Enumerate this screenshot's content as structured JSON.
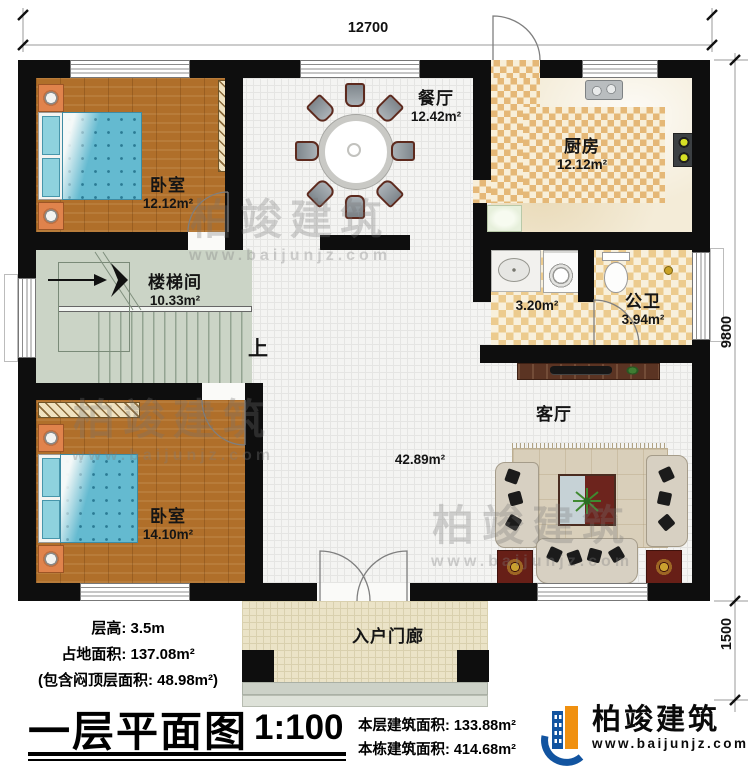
{
  "plan": {
    "dim_top": "12700",
    "dim_right": "9800",
    "dim_porch": "1500",
    "up": "上"
  },
  "rooms": {
    "bedroom1": {
      "name": "卧室",
      "area": "12.12m²"
    },
    "dining": {
      "name": "餐厅",
      "area": "12.42m²"
    },
    "kitchen": {
      "name": "厨房",
      "area": "12.12m²"
    },
    "stairwell": {
      "name": "楼梯间",
      "area": "10.33m²"
    },
    "wash": {
      "area": "3.20m²"
    },
    "toilet": {
      "name": "公卫",
      "area": "3.94m²"
    },
    "living": {
      "name": "客厅",
      "area": "42.89m²"
    },
    "bedroom2": {
      "name": "卧室",
      "area": "14.10m²"
    },
    "porch": {
      "name": "入户门廊"
    }
  },
  "notes": {
    "line1": "层高: 3.5m",
    "line2": "占地面积: 137.08m²",
    "line3": "(包含闷顶层面积: 48.98m²)"
  },
  "title_block": {
    "title": "一层平面图",
    "scale": "1:100",
    "floor_area": "本层建筑面积: 133.88m²",
    "building_area": "本栋建筑面积: 414.68m²"
  },
  "brand": {
    "name": "柏竣建筑",
    "url": "www.baijunjz.com"
  },
  "watermark": {
    "name": "柏竣建筑",
    "url": "www.baijunjz.com"
  },
  "colors": {
    "wall": "#0e0e0e",
    "wood": "#b06f2a",
    "counter_tan": "#e5b877",
    "brand_blue": "#1254a0",
    "brand_orange": "#f0900f"
  }
}
